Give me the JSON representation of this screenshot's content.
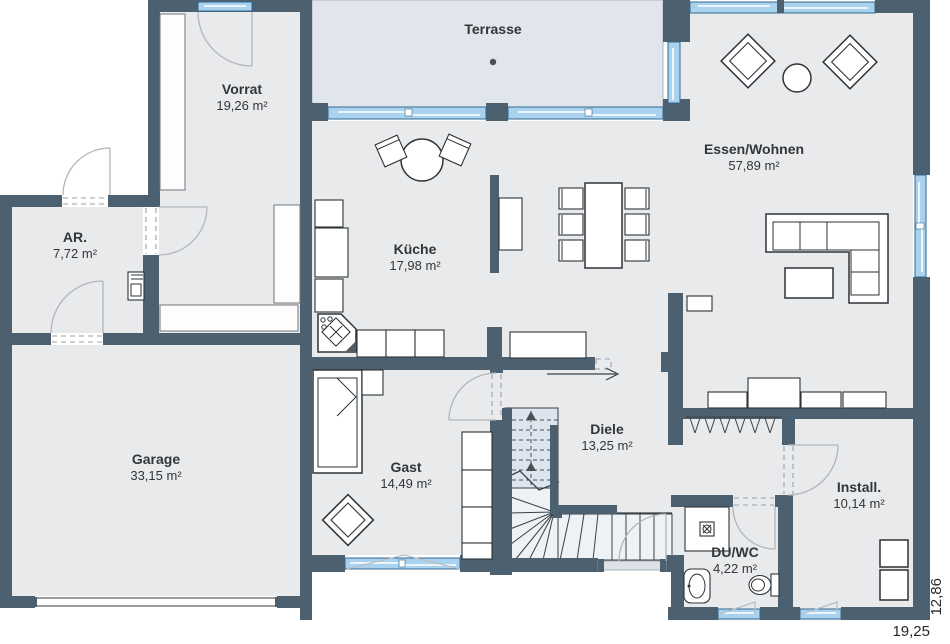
{
  "rooms": {
    "terrasse": {
      "label": "Terrasse",
      "area": ""
    },
    "vorrat": {
      "label": "Vorrat",
      "area": "19,26 m²"
    },
    "essen_wohnen": {
      "label": "Essen/Wohnen",
      "area": "57,89 m²"
    },
    "ar": {
      "label": "AR.",
      "area": "7,72 m²"
    },
    "kueche": {
      "label": "Küche",
      "area": "17,98 m²"
    },
    "garage": {
      "label": "Garage",
      "area": "33,15 m²"
    },
    "gast": {
      "label": "Gast",
      "area": "14,49 m²"
    },
    "diele": {
      "label": "Diele",
      "area": "13,25 m²"
    },
    "install": {
      "label": "Install.",
      "area": "10,14 m²"
    },
    "du_wc": {
      "label": "DU/WC",
      "area": "4,22 m²"
    }
  },
  "dimensions": {
    "width_label": "19,25",
    "height_label": "12,86"
  },
  "colors": {
    "wall": "#4c6070",
    "floor": "#e9eaeb",
    "terrace_floor": "#e0e6eb",
    "glass": "#a8d2ee",
    "glass_edge": "#33688f",
    "stairs_upper": "#dce4ee",
    "stairs_lower": "#eef1f5",
    "furniture_outline": "#2e3338"
  }
}
